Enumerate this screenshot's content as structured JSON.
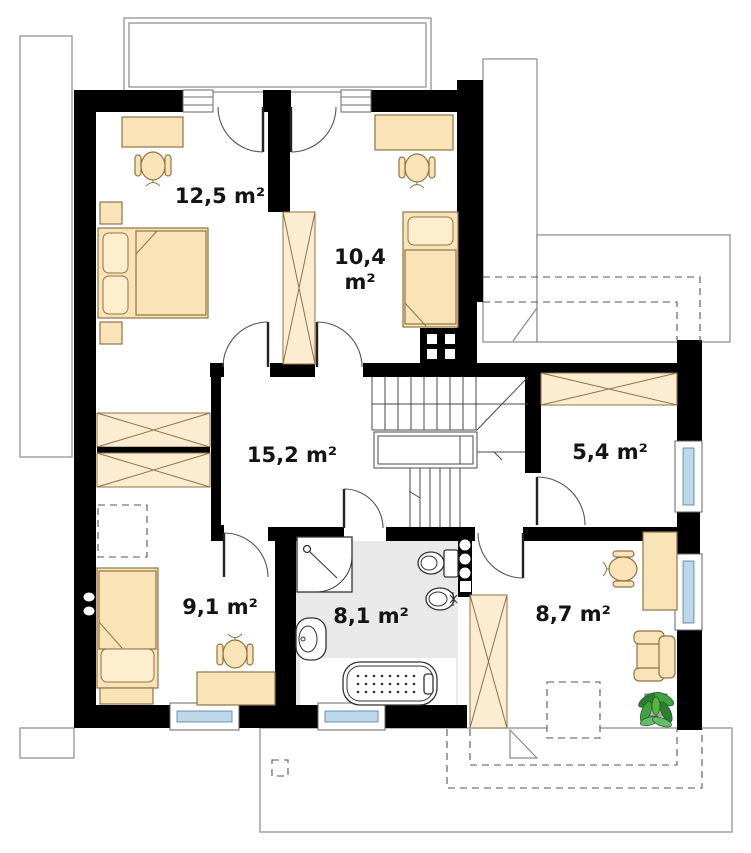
{
  "plan": {
    "rooms": [
      {
        "name": "bedroom-top-left",
        "area": "12,5 m²"
      },
      {
        "name": "bedroom-top-right",
        "area_value": "10,4",
        "area_unit": "m²"
      },
      {
        "name": "hall",
        "area": "15,2 m²"
      },
      {
        "name": "wardrobe-room",
        "area": "5,4 m²"
      },
      {
        "name": "bedroom-bottom-left",
        "area": "9,1 m²"
      },
      {
        "name": "bathroom",
        "area": "8,1 m²"
      },
      {
        "name": "room-bottom-right",
        "area": "8,7 m²"
      }
    ],
    "colors": {
      "wall": "#000000",
      "furniture_fill": "#fbe3b8",
      "wardrobe_fill": "#fcecd2",
      "furniture_stroke": "#8f7345",
      "window_glass": "#bdd8eb",
      "bathroom_floor": "#e9e9e9",
      "plant_green": "#3f9b34",
      "label_text": "#141414",
      "outline_gray": "#8a8a8a"
    },
    "icons": [
      "double-bed",
      "single-bed",
      "desk",
      "office-chair",
      "wardrobe",
      "nightstand",
      "shower",
      "toilet",
      "bidet",
      "washbasin",
      "bathtub",
      "armchair",
      "potted-plant",
      "staircase",
      "chimney",
      "window",
      "door-swing",
      "balcony",
      "roof-outline",
      "roof-window"
    ]
  }
}
